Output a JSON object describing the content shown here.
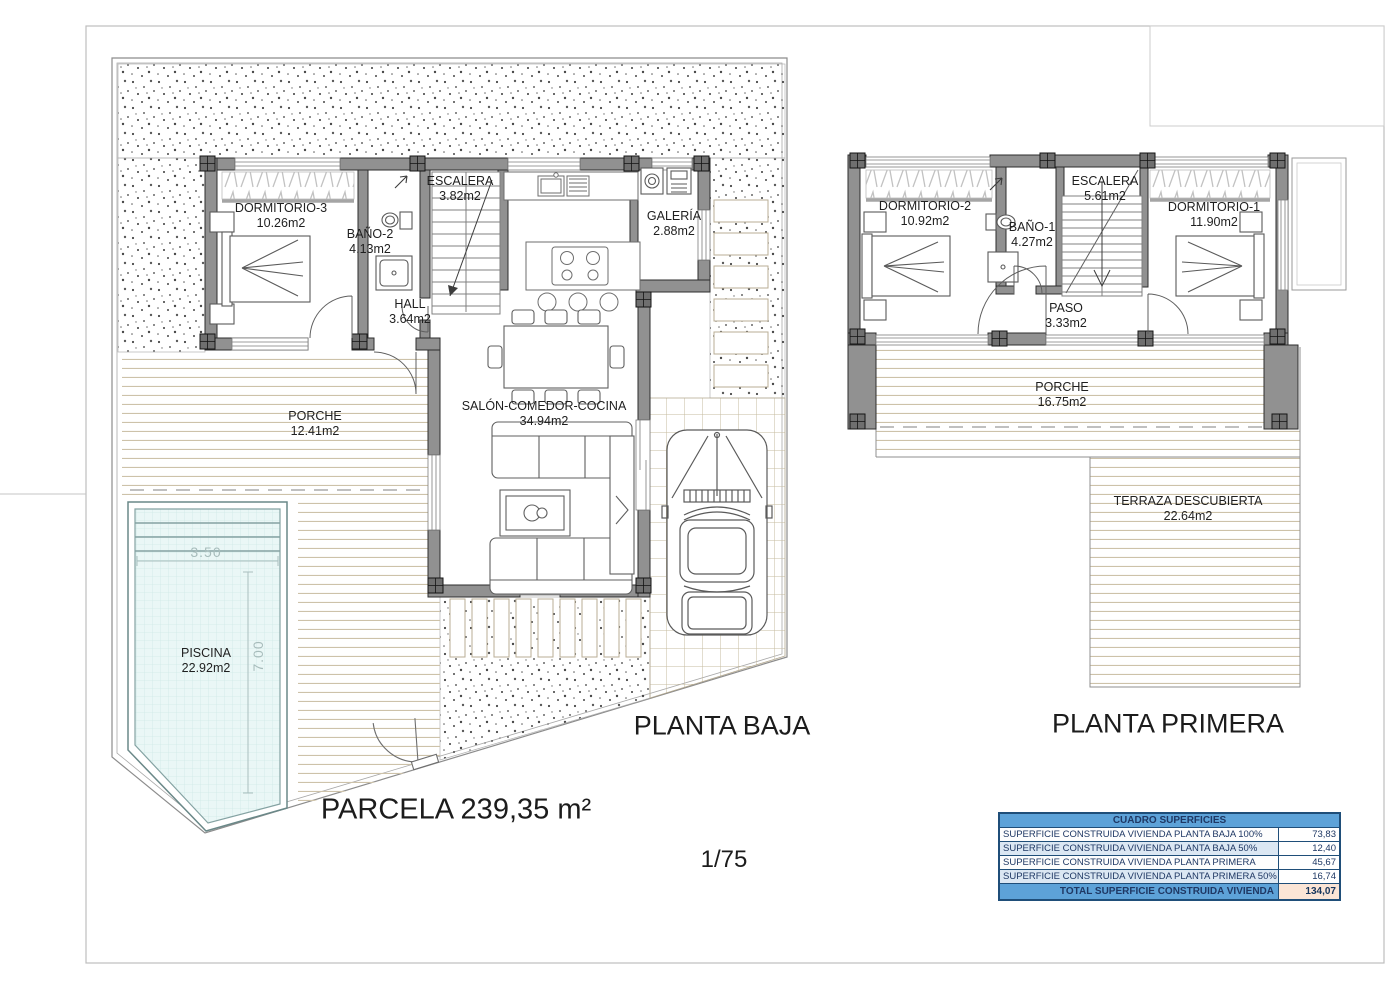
{
  "sheet": {
    "parcel_label": "PARCELA 239,35 m²",
    "scale": "1/75"
  },
  "floors": {
    "baja": {
      "title": "PLANTA BAJA",
      "rooms": [
        {
          "name": "DORMITORIO-3",
          "area": "10.26m2"
        },
        {
          "name": "BAÑO-2",
          "area": "4.13m2"
        },
        {
          "name": "ESCALERA",
          "area": "3.82m2"
        },
        {
          "name": "HALL",
          "area": "3.64m2"
        },
        {
          "name": "GALERÍA",
          "area": "2.88m2"
        },
        {
          "name": "SALÓN-COMEDOR-COCINA",
          "area": "34.94m2"
        },
        {
          "name": "PORCHE",
          "area": "12.41m2"
        },
        {
          "name": "PISCINA",
          "area": "22.92m2"
        }
      ],
      "pool_dimensions": {
        "width": "3.50",
        "length": "7.00"
      }
    },
    "primera": {
      "title": "PLANTA PRIMERA",
      "rooms": [
        {
          "name": "DORMITORIO-2",
          "area": "10.92m2"
        },
        {
          "name": "BAÑO-1",
          "area": "4.27m2"
        },
        {
          "name": "ESCALERA",
          "area": "5.61m2"
        },
        {
          "name": "DORMITORIO-1",
          "area": "11.90m2"
        },
        {
          "name": "PASO",
          "area": "3.33m2"
        },
        {
          "name": "PORCHE",
          "area": "16.75m2"
        },
        {
          "name": "TERRAZA DESCUBIERTA",
          "area": "22.64m2"
        }
      ]
    }
  },
  "surfaces_table": {
    "title": "CUADRO SUPERFICIES",
    "rows": [
      {
        "label": "SUPERFICIE CONSTRUIDA VIVIENDA PLANTA BAJA 100%",
        "value": "73,83"
      },
      {
        "label": "SUPERFICIE CONSTRUIDA VIVIENDA PLANTA BAJA 50%",
        "value": "12,40"
      },
      {
        "label": "SUPERFICIE CONSTRUIDA VIVIENDA PLANTA PRIMERA 100%",
        "value": "45,67"
      },
      {
        "label": "SUPERFICIE CONSTRUIDA VIVIENDA PLANTA PRIMERA 50%",
        "value": "16,74"
      }
    ],
    "total": {
      "label": "TOTAL SUPERFICIE CONSTRUIDA VIVIENDA",
      "value": "134,07"
    }
  },
  "colors": {
    "wall_fill": "#919191",
    "pool_fill": "#eaf7f6",
    "deck_line": "#cdc2a9",
    "table_header_bg": "#5da2d8",
    "table_alt_row_bg": "#dbe7f3",
    "table_total_value_bg": "#fbe5d6",
    "table_text": "#1f3864"
  }
}
